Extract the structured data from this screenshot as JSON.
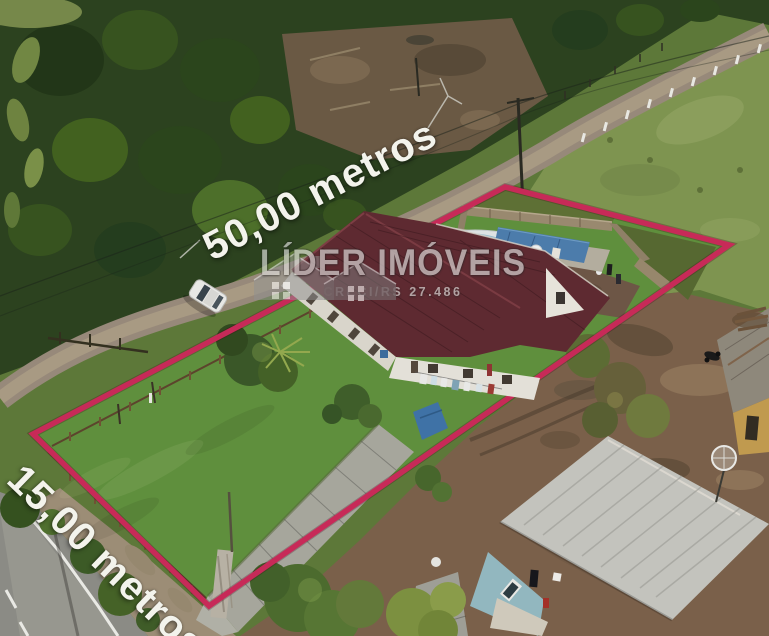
{
  "annotations": {
    "depth_label": "50,00 metros",
    "frontage_label": "15,00 metros"
  },
  "watermark": {
    "brand": "LÍDER IMÓVEIS",
    "registration": "CRECI/RS 27.486"
  },
  "scene": {
    "boundary_color": "#c72a58",
    "label_color": "#f3f3ec",
    "watermark_color": "#e0e0de",
    "description": "Aerial drone photo of a 15 m x 50 m residential lot outlined in magenta: maroon-roofed house with covered pool, lawn and driveway, gravel road with white car above, paved road below-left, neighbouring houses on dirt yard bottom-right"
  }
}
